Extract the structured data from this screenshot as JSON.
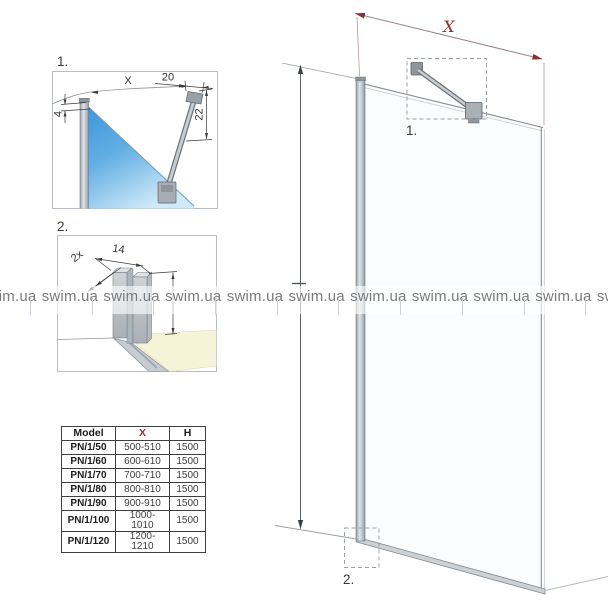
{
  "watermark": {
    "text": "swim.ua"
  },
  "detail1": {
    "label": "1.",
    "dim_x": "X",
    "dim_top": "20",
    "dim_left": "4",
    "dim_right": "22"
  },
  "detail2": {
    "label": "2.",
    "dim_width": "14",
    "dim_qty": "2x"
  },
  "main": {
    "dim_width_label": "X",
    "callout1_label": "1.",
    "callout2_label": "2."
  },
  "table": {
    "header_model": "Model",
    "header_x": "X",
    "header_h": "H",
    "rows": [
      [
        "PN/1/50",
        "500-510",
        "1500"
      ],
      [
        "PN/1/60",
        "600-610",
        "1500"
      ],
      [
        "PN/1/70",
        "700-710",
        "1500"
      ],
      [
        "PN/1/80",
        "800-810",
        "1500"
      ],
      [
        "PN/1/90",
        "900-910",
        "1500"
      ],
      [
        "PN/1/100",
        "1000-1010",
        "1500"
      ],
      [
        "PN/1/120",
        "1200-1210",
        "1500"
      ]
    ]
  },
  "colors": {
    "accent_red": "#8b3030",
    "dim_red_line": "#9b8383",
    "line_gray": "#868d93",
    "text_dark": "#3a3a3a",
    "glass_blue": "#3e97dd",
    "floor_beige": "#f5f3d8",
    "watermark_gray": "#7b7b7b"
  }
}
